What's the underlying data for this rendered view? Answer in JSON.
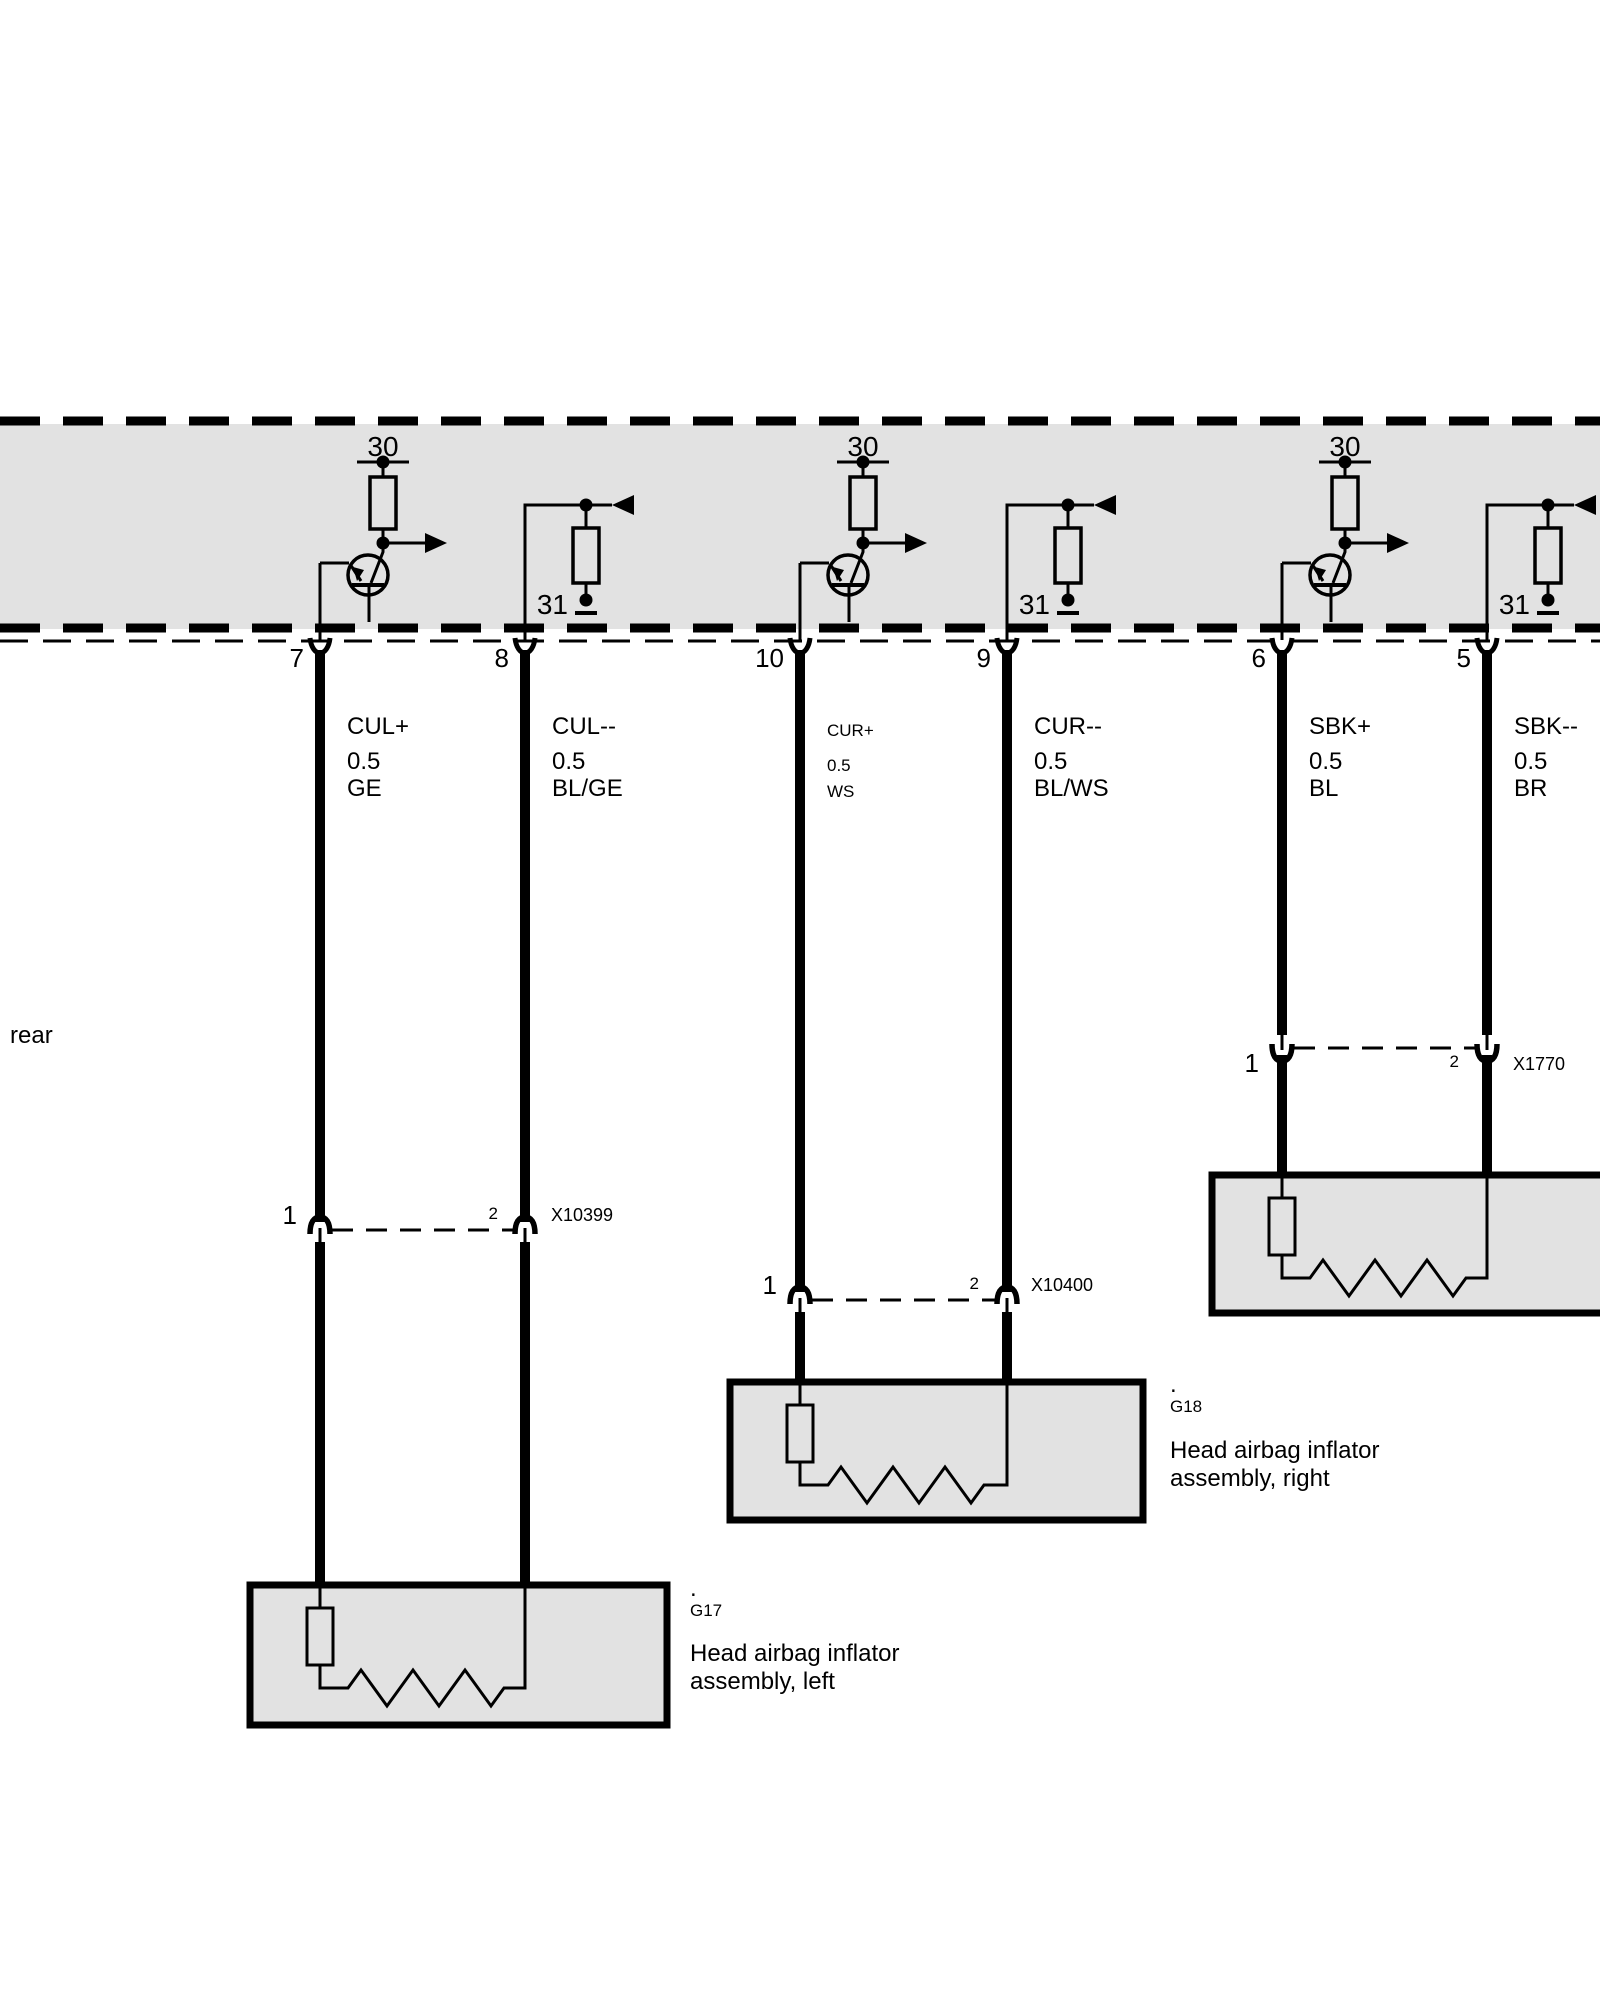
{
  "side_label": "rear",
  "colors": {
    "background": "#ffffff",
    "band_fill": "#e2e2e2",
    "box_fill": "#e2e2e2",
    "line": "#000000"
  },
  "band": {
    "groups": [
      {
        "terminal_top": "30",
        "terminal_ground": "31"
      },
      {
        "terminal_top": "30",
        "terminal_ground": "31"
      },
      {
        "terminal_top": "30",
        "terminal_ground": "31"
      }
    ]
  },
  "wires": [
    {
      "pin": "7",
      "signal": "CUL+",
      "gauge": "0.5",
      "color_code": "GE"
    },
    {
      "pin": "8",
      "signal": "CUL--",
      "gauge": "0.5",
      "color_code": "BL/GE"
    },
    {
      "pin": "10",
      "signal": "CUR+",
      "gauge": "0.5",
      "color_code": "WS"
    },
    {
      "pin": "9",
      "signal": "CUR--",
      "gauge": "0.5",
      "color_code": "BL/WS"
    },
    {
      "pin": "6",
      "signal": "SBK+",
      "gauge": "0.5",
      "color_code": "BL"
    },
    {
      "pin": "5",
      "signal": "SBK--",
      "gauge": "0.5",
      "color_code": "BR"
    }
  ],
  "connectors": [
    {
      "id": "X10399",
      "left_pin": "1",
      "right_pin": "2"
    },
    {
      "id": "X10400",
      "left_pin": "1",
      "right_pin": "2"
    },
    {
      "id": "X1770",
      "left_pin": "1",
      "right_pin": "2"
    }
  ],
  "components": [
    {
      "id": "G17",
      "marker": ".",
      "name_line1": "Head airbag inflator",
      "name_line2": "assembly, left"
    },
    {
      "id": "G18",
      "marker": ".",
      "name_line1": "Head airbag inflator",
      "name_line2": "assembly, right"
    }
  ]
}
